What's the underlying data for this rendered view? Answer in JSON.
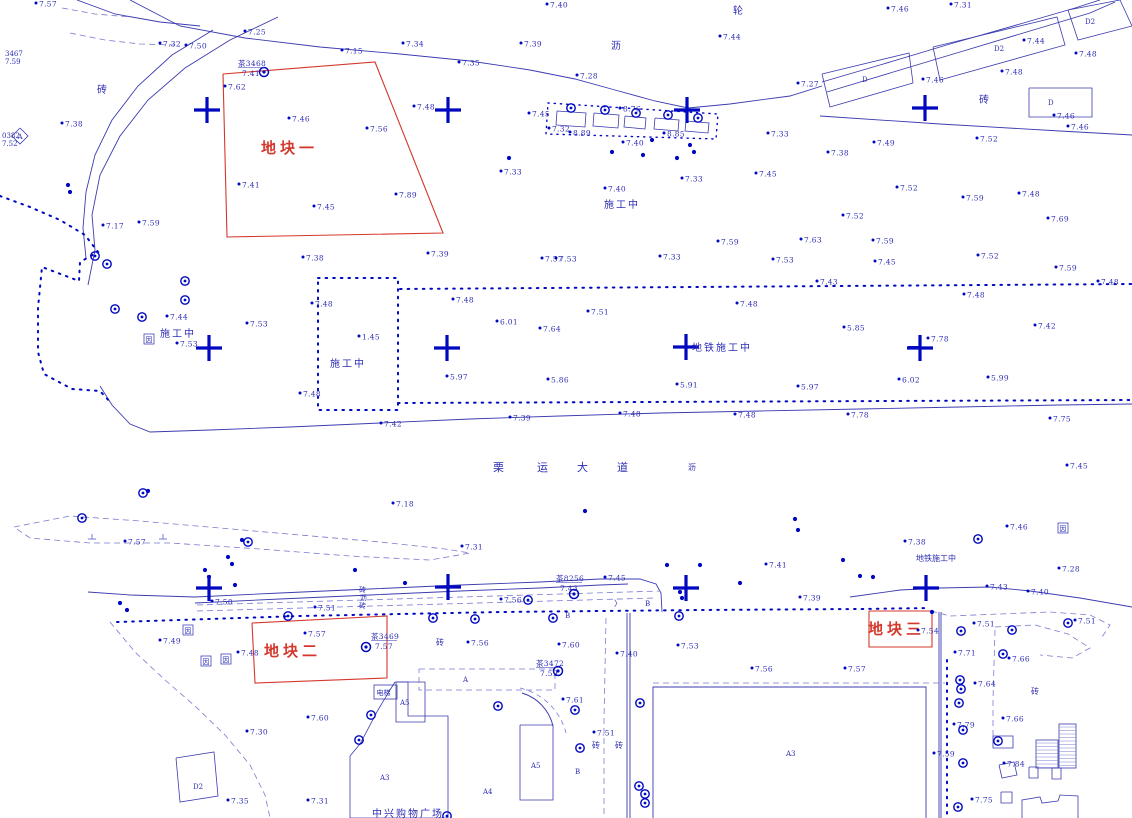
{
  "map": {
    "type": "survey-cadastral-map",
    "background": "#ffffff",
    "colors": {
      "line": "#3b3bb0",
      "point": "#0008c0",
      "text": "#2d2db4",
      "red": "#d4372c",
      "light": "#7a7ad0"
    },
    "parcels": [
      {
        "name": "地块一",
        "points": [
          [
            223,
            74
          ],
          [
            375,
            62
          ],
          [
            443,
            233
          ],
          [
            227,
            237
          ]
        ],
        "label_x": 293,
        "label_y": 153
      },
      {
        "name": "地块二",
        "points": [
          [
            252,
            623
          ],
          [
            387,
            616
          ],
          [
            387,
            678
          ],
          [
            255,
            683
          ]
        ],
        "label_x": 296,
        "label_y": 656
      },
      {
        "name": "地块三",
        "points": [
          [
            869,
            611
          ],
          [
            932,
            611
          ],
          [
            932,
            647
          ],
          [
            869,
            647
          ]
        ],
        "label_x": 900,
        "label_y": 634
      }
    ],
    "crosses": [
      [
        207,
        110
      ],
      [
        448,
        110
      ],
      [
        687,
        110
      ],
      [
        925,
        108
      ],
      [
        209,
        348
      ],
      [
        447,
        348
      ],
      [
        686,
        347
      ],
      [
        920,
        348
      ],
      [
        209,
        588
      ],
      [
        448,
        587
      ],
      [
        686,
        588
      ],
      [
        926,
        588
      ]
    ],
    "control_points": [
      {
        "x": 264,
        "y": 72,
        "name": "茶3468",
        "elev": "7.41",
        "tx": 238,
        "ty": 66
      },
      {
        "x": 574,
        "y": 594,
        "name": "茶8256",
        "elev": "7.43",
        "tx": 556,
        "ty": 581
      },
      {
        "x": 366,
        "y": 647,
        "name": "茶3469",
        "elev": "7.57",
        "tx": 371,
        "ty": 639
      },
      {
        "x": 558,
        "y": 671,
        "name": "茶3472",
        "elev": "7.59",
        "tx": 536,
        "ty": 666
      }
    ],
    "spots": [
      [
        36,
        3,
        "7.57"
      ],
      [
        160,
        43,
        "7.32"
      ],
      [
        186,
        45,
        "7.50"
      ],
      [
        245,
        31,
        "7.25"
      ],
      [
        342,
        50,
        "7.15"
      ],
      [
        403,
        43,
        "7.34"
      ],
      [
        459,
        62,
        "7.35"
      ],
      [
        521,
        43,
        "7.39"
      ],
      [
        547,
        4,
        "7.40"
      ],
      [
        577,
        75,
        "7.28"
      ],
      [
        720,
        36,
        "7.44"
      ],
      [
        798,
        83,
        "7.27"
      ],
      [
        888,
        8,
        "7.46"
      ],
      [
        951,
        4,
        "7.31"
      ],
      [
        1024,
        40,
        "7.44"
      ],
      [
        1076,
        53,
        "7.48"
      ],
      [
        1002,
        71,
        "7.48"
      ],
      [
        923,
        79,
        "7.46"
      ],
      [
        1054,
        115,
        "7.46"
      ],
      [
        1068,
        126,
        "7.46"
      ],
      [
        977,
        138,
        "7.52"
      ],
      [
        874,
        142,
        "7.49"
      ],
      [
        828,
        152,
        "7.38"
      ],
      [
        62,
        123,
        "7.38"
      ],
      [
        225,
        86,
        "7.62"
      ],
      [
        239,
        184,
        "7.41"
      ],
      [
        314,
        206,
        "7.45"
      ],
      [
        289,
        118,
        "7.46"
      ],
      [
        367,
        128,
        "7.56"
      ],
      [
        396,
        194,
        "7.89"
      ],
      [
        414,
        106,
        "7.48"
      ],
      [
        529,
        113,
        "7.45"
      ],
      [
        501,
        171,
        "7.33"
      ],
      [
        605,
        188,
        "7.40"
      ],
      [
        682,
        178,
        "7.33"
      ],
      [
        756,
        173,
        "7.45"
      ],
      [
        768,
        133,
        "7.33"
      ],
      [
        549,
        128,
        "7.32"
      ],
      [
        570,
        132,
        "8.89"
      ],
      [
        620,
        108,
        "8.76"
      ],
      [
        664,
        133,
        "8.85"
      ],
      [
        623,
        142,
        "7.40"
      ],
      [
        103,
        225,
        "7.17"
      ],
      [
        139,
        222,
        "7.59"
      ],
      [
        303,
        257,
        "7.38"
      ],
      [
        428,
        253,
        "7.39"
      ],
      [
        542,
        258,
        "7.57"
      ],
      [
        556,
        258,
        "7.53"
      ],
      [
        660,
        256,
        "7.33"
      ],
      [
        773,
        259,
        "7.53"
      ],
      [
        718,
        241,
        "7.59"
      ],
      [
        801,
        239,
        "7.63"
      ],
      [
        873,
        240,
        "7.59"
      ],
      [
        875,
        261,
        "7.45"
      ],
      [
        843,
        215,
        "7.52"
      ],
      [
        897,
        187,
        "7.52"
      ],
      [
        963,
        197,
        "7.59"
      ],
      [
        1019,
        193,
        "7.48"
      ],
      [
        1048,
        218,
        "7.69"
      ],
      [
        978,
        255,
        "7.52"
      ],
      [
        1056,
        267,
        "7.59"
      ],
      [
        964,
        294,
        "7.48"
      ],
      [
        1098,
        281,
        "7.48"
      ],
      [
        167,
        316,
        "7.44"
      ],
      [
        247,
        323,
        "7.53"
      ],
      [
        177,
        343,
        "7.53"
      ],
      [
        312,
        303,
        "7.48"
      ],
      [
        300,
        393,
        "7.48"
      ],
      [
        453,
        299,
        "7.48"
      ],
      [
        497,
        321,
        "6.01"
      ],
      [
        359,
        336,
        "1.45"
      ],
      [
        447,
        376,
        "5.97"
      ],
      [
        588,
        311,
        "7.51"
      ],
      [
        540,
        328,
        "7.64"
      ],
      [
        548,
        379,
        "5.86"
      ],
      [
        817,
        281,
        "7.43"
      ],
      [
        737,
        303,
        "7.48"
      ],
      [
        844,
        327,
        "5.85"
      ],
      [
        677,
        384,
        "5.91"
      ],
      [
        798,
        386,
        "5.97"
      ],
      [
        899,
        379,
        "6.02"
      ],
      [
        988,
        377,
        "5.99"
      ],
      [
        928,
        338,
        "7.78"
      ],
      [
        1035,
        325,
        "7.42"
      ],
      [
        381,
        423,
        "7.42"
      ],
      [
        510,
        417,
        "7.39"
      ],
      [
        620,
        413,
        "7.48"
      ],
      [
        735,
        414,
        "7.48"
      ],
      [
        848,
        414,
        "7.78"
      ],
      [
        1050,
        418,
        "7.75"
      ],
      [
        1067,
        465,
        "7.45"
      ],
      [
        393,
        503,
        "7.18"
      ],
      [
        125,
        541,
        "7.57"
      ],
      [
        462,
        546,
        "7.31"
      ],
      [
        1007,
        526,
        "7.46"
      ],
      [
        905,
        541,
        "7.38"
      ],
      [
        1059,
        568,
        "7.28"
      ],
      [
        766,
        564,
        "7.41"
      ],
      [
        605,
        577,
        "7.45"
      ],
      [
        987,
        586,
        "7.43"
      ],
      [
        1028,
        591,
        "7.40"
      ],
      [
        212,
        601,
        "7.50"
      ],
      [
        315,
        607,
        "7.51"
      ],
      [
        800,
        597,
        "7.39"
      ],
      [
        501,
        599,
        "7.56"
      ],
      [
        160,
        640,
        "7.49"
      ],
      [
        238,
        652,
        "7.48"
      ],
      [
        305,
        633,
        "7.57"
      ],
      [
        468,
        642,
        "7.56"
      ],
      [
        559,
        644,
        "7.60"
      ],
      [
        678,
        645,
        "7.53"
      ],
      [
        752,
        668,
        "7.56"
      ],
      [
        845,
        668,
        "7.57"
      ],
      [
        617,
        653,
        "7.40"
      ],
      [
        1075,
        620,
        "7.51"
      ],
      [
        974,
        623,
        "7.51"
      ],
      [
        918,
        630,
        "7.54"
      ],
      [
        955,
        652,
        "7.71"
      ],
      [
        1009,
        658,
        "7.66"
      ],
      [
        975,
        683,
        "7.64"
      ],
      [
        1003,
        718,
        "7.66"
      ],
      [
        954,
        724,
        "7.79"
      ],
      [
        934,
        753,
        "7.59"
      ],
      [
        1004,
        763,
        "7.84"
      ],
      [
        972,
        799,
        "7.75"
      ],
      [
        563,
        699,
        "7.61"
      ],
      [
        594,
        732,
        "7.51"
      ],
      [
        308,
        717,
        "7.60"
      ],
      [
        247,
        731,
        "7.30"
      ],
      [
        228,
        800,
        "7.35"
      ],
      [
        308,
        800,
        "7.31"
      ]
    ],
    "labels": [
      {
        "x": 97,
        "y": 93,
        "t": "砖",
        "cls": "cn-m"
      },
      {
        "x": 733,
        "y": 14,
        "t": "轮",
        "cls": "cn-m"
      },
      {
        "x": 611,
        "y": 49,
        "t": "沥",
        "cls": "cn-m"
      },
      {
        "x": 979,
        "y": 103,
        "t": "砖",
        "cls": "cn-m"
      },
      {
        "x": 604,
        "y": 208,
        "t": "施工中",
        "cls": "cn-m"
      },
      {
        "x": 160,
        "y": 337,
        "t": "施工中",
        "cls": "cn-m"
      },
      {
        "x": 330,
        "y": 367,
        "t": "施工中",
        "cls": "cn-m"
      },
      {
        "x": 692,
        "y": 351,
        "t": "地铁施工中",
        "cls": "cn-m"
      },
      {
        "x": 916,
        "y": 561,
        "t": "地铁施工中",
        "cls": "cn-s"
      },
      {
        "x": 493,
        "y": 471,
        "t": "栗",
        "cls": "road-t"
      },
      {
        "x": 537,
        "y": 471,
        "t": "运",
        "cls": "road-t"
      },
      {
        "x": 577,
        "y": 471,
        "t": "大",
        "cls": "road-t"
      },
      {
        "x": 617,
        "y": 471,
        "t": "道",
        "cls": "road-t"
      },
      {
        "x": 688,
        "y": 470,
        "t": "沥",
        "cls": "cn-s"
      },
      {
        "x": 359,
        "y": 592,
        "t": "砖",
        "cls": "bld-t"
      },
      {
        "x": 360,
        "y": 600,
        "t": "沥",
        "cls": "bld-t"
      },
      {
        "x": 359,
        "y": 608,
        "t": "砖",
        "cls": "bld-t"
      },
      {
        "x": 436,
        "y": 645,
        "t": "砖",
        "cls": "cn-s"
      },
      {
        "x": 1031,
        "y": 694,
        "t": "砖",
        "cls": "cn-s"
      },
      {
        "x": 592,
        "y": 748,
        "t": "砖",
        "cls": "cn-s"
      },
      {
        "x": 615,
        "y": 748,
        "t": "砖",
        "cls": "cn-s"
      },
      {
        "x": 372,
        "y": 817,
        "t": "中兴购物广场",
        "cls": "cn-m"
      },
      {
        "x": 380,
        "y": 780,
        "t": "A3",
        "cls": "bld-t"
      },
      {
        "x": 483,
        "y": 794,
        "t": "A4",
        "cls": "bld-t"
      },
      {
        "x": 400,
        "y": 705,
        "t": "A5",
        "cls": "bld-t"
      },
      {
        "x": 531,
        "y": 768,
        "t": "A5",
        "cls": "bld-t"
      },
      {
        "x": 575,
        "y": 774,
        "t": "B",
        "cls": "bld-t"
      },
      {
        "x": 565,
        "y": 618,
        "t": "B",
        "cls": "bld-t"
      },
      {
        "x": 645,
        "y": 606,
        "t": "B",
        "cls": "bld-t"
      },
      {
        "x": 463,
        "y": 682,
        "t": "A",
        "cls": "bld-t"
      },
      {
        "x": 786,
        "y": 756,
        "t": "A3",
        "cls": "bld-t"
      },
      {
        "x": 862,
        "y": 82,
        "t": "D",
        "cls": "bld-t"
      },
      {
        "x": 994,
        "y": 51,
        "t": "D2",
        "cls": "bld-t"
      },
      {
        "x": 1085,
        "y": 24,
        "t": "D2",
        "cls": "bld-t"
      },
      {
        "x": 1048,
        "y": 105,
        "t": "D",
        "cls": "bld-t"
      },
      {
        "x": 193,
        "y": 789,
        "t": "D2",
        "cls": "bld-t"
      },
      {
        "x": 5,
        "y": 56,
        "t": "3467",
        "cls": "bld-t"
      },
      {
        "x": 5,
        "y": 64,
        "t": "7.59",
        "cls": "bld-t"
      },
      {
        "x": 2,
        "y": 138,
        "t": "0382",
        "cls": "bld-t"
      },
      {
        "x": 2,
        "y": 146,
        "t": "7.52",
        "cls": "bld-t"
      },
      {
        "x": 614,
        "y": 606,
        "t": "〉",
        "cls": "cn-s"
      }
    ],
    "boxed_labels": [
      {
        "x": 149,
        "y": 339,
        "t": "因"
      },
      {
        "x": 1063,
        "y": 528,
        "t": "因"
      },
      {
        "x": 188,
        "y": 630,
        "t": "因"
      },
      {
        "x": 206,
        "y": 661,
        "t": "因"
      },
      {
        "x": 226,
        "y": 659,
        "t": "因"
      }
    ],
    "elevator_label": {
      "x": 374,
      "y": 685,
      "w": 23,
      "h": 14,
      "t": "电梯"
    },
    "corner_square_label": {
      "x": 20,
      "y": 136,
      "t": "A"
    }
  }
}
